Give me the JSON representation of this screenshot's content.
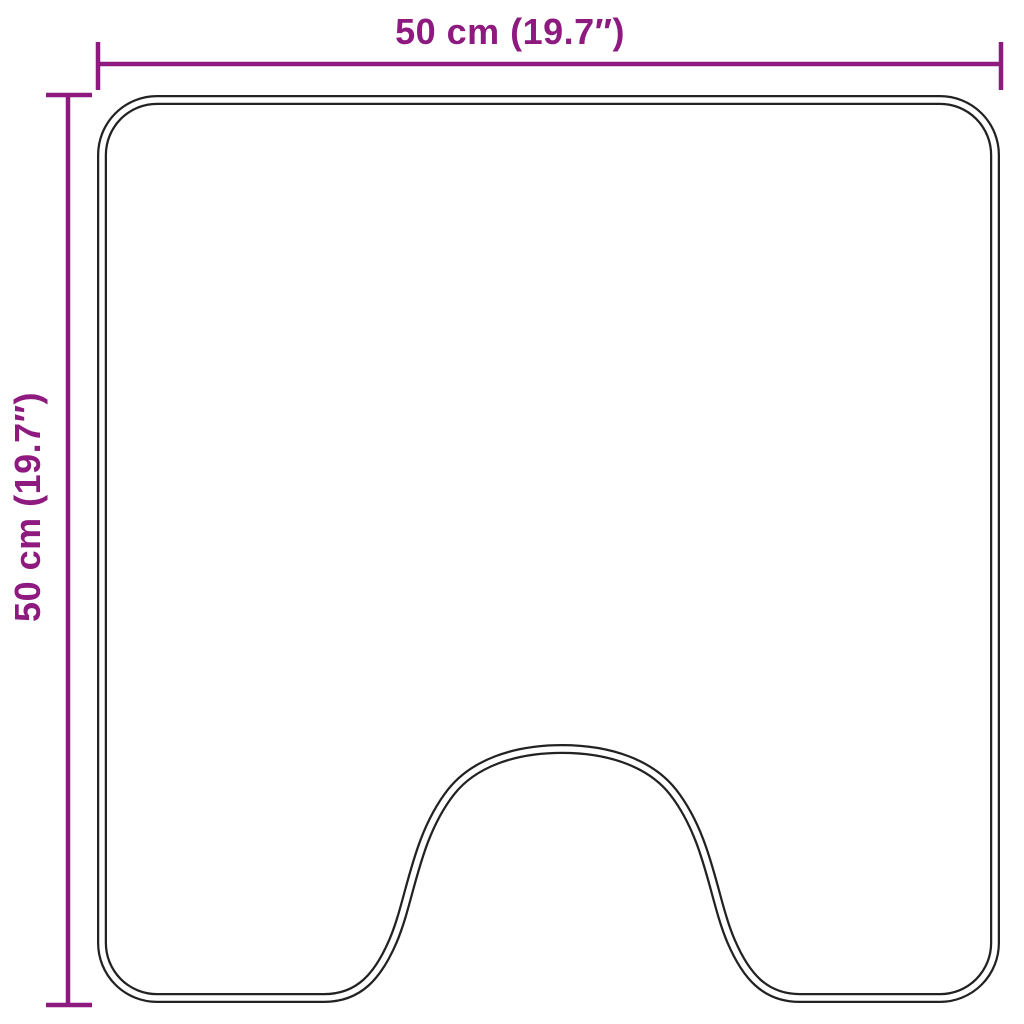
{
  "diagram": {
    "width_label": "50 cm (19.7″)",
    "height_label": "50 cm (19.7″)"
  },
  "colors": {
    "dimension": "#8e1a80",
    "outline": "#222222",
    "background": "#ffffff"
  }
}
